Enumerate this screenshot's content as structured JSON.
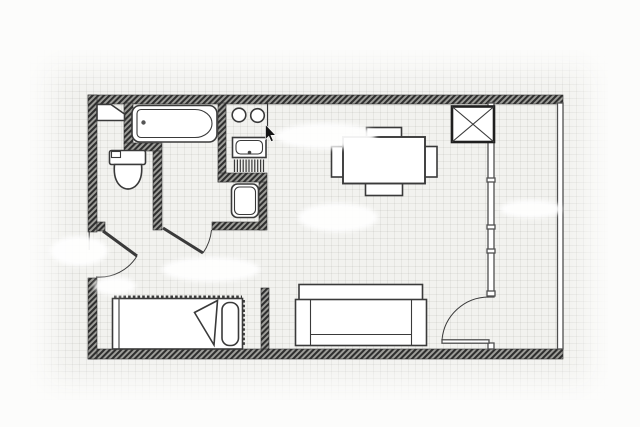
{
  "app": {
    "title": "Studio apartment floor plan",
    "type": "architectural-drawing",
    "visible_text": "none"
  },
  "colors": {
    "background": "#fcfcfb",
    "paper": "#f2f2ef",
    "grid": "rgba(140,140,135,0.12)",
    "wallFill": "#9e9e9a",
    "wallStripe": "#2e2e2e",
    "wallEdge": "#2f2f2f",
    "thinWall": "#4f4f4f",
    "line": "#3a3a3a",
    "smudge": "#ffffff",
    "cursor": "#141414"
  },
  "plan": {
    "rooms": [
      "entrance-hall",
      "wc",
      "bathroom",
      "kitchenette-corner",
      "living-dining-area",
      "sleeping-nook",
      "balcony"
    ],
    "fixtures": [
      "bathtub-with-faucet",
      "toilet-with-cistern",
      "corner-shelf",
      "washbasin",
      "kitchen-sink-with-drain",
      "two-burner-cooktop",
      "drainer-hatching",
      "duct-shaft-x-box"
    ],
    "furniture": [
      "dining-table",
      "chair-top",
      "chair-bottom",
      "chair-left",
      "chair-right",
      "single-bed-with-pillow-and-folded-blanket",
      "sofa-with-armrests"
    ],
    "doors": [
      "entrance-door",
      "bathroom-door",
      "balcony-door"
    ],
    "windows": [
      "balcony-window-wall-with-mullions",
      "balcony-outer-glazing"
    ],
    "erased_label_smudges": 6,
    "cursor": "arrow-pointer"
  }
}
